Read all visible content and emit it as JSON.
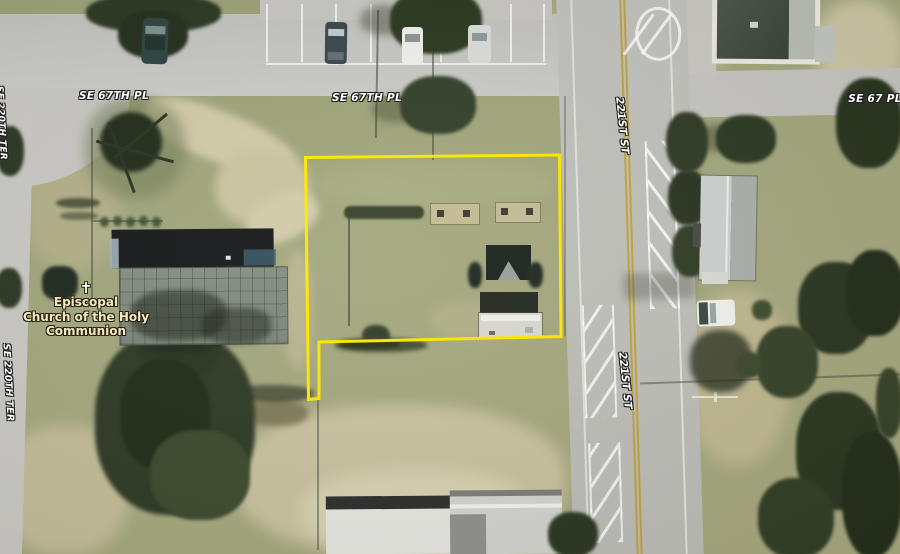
{
  "map": {
    "street_labels": {
      "se_67th_pl_west": "SE 67TH PL",
      "se_67th_pl_center": "SE 67TH PL",
      "se_67_pl_east": "SE 67 PL",
      "st_221_north": "221ST ST",
      "st_221_south": "221ST ST",
      "se_220th_ter": "SE 220TH TER",
      "se_220th_ter_top": "SE 220TH TER"
    },
    "poi_label": {
      "symbol": "✝",
      "line1": "Episcopal",
      "line2": "Church of the Holy",
      "line3": "Communion"
    },
    "colors": {
      "parcel_outline": "#ffe800",
      "street_label_text": "#ffffff",
      "poi_label_text": "#f2e9c0",
      "road_centerline": "#c2a33c"
    }
  }
}
